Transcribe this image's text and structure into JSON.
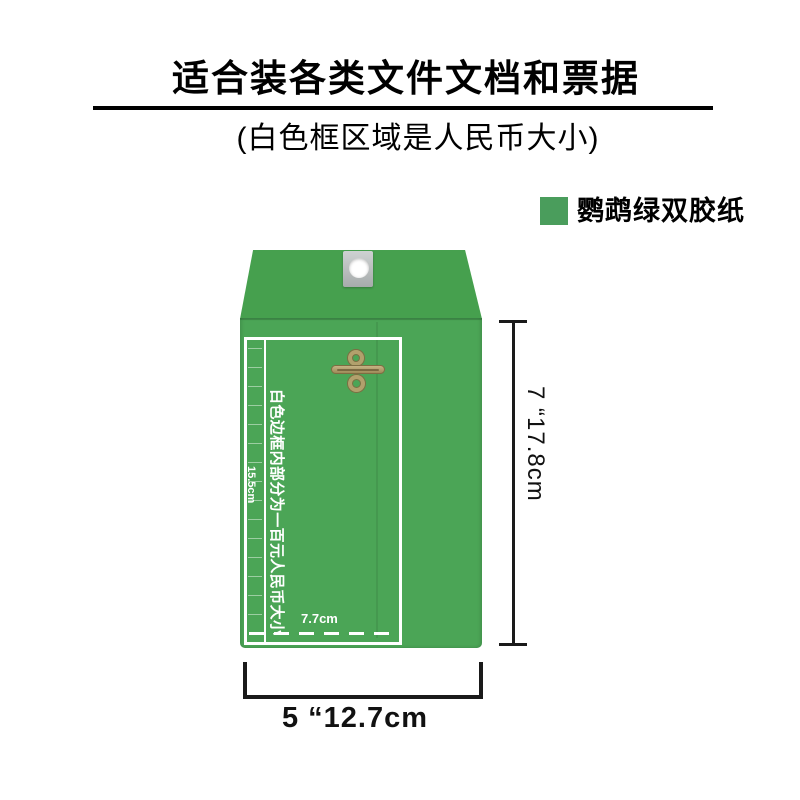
{
  "header": {
    "title": "适合装各类文件文档和票据",
    "subtitle": "(白色框区域是人民币大小)"
  },
  "legend": {
    "label": "鹦鹉绿双胶纸",
    "swatch_color": "#4a9d5c"
  },
  "envelope": {
    "body_color": "#4ba556",
    "flap_color": "#46a04e",
    "clasp_color": "#b2a06c",
    "inner_note": "白色边框内部分为一百元人民币大小",
    "inner_height_label": "15.5cm",
    "inner_width_label": "7.7cm"
  },
  "dimensions": {
    "height_label": "7 “17.8cm",
    "width_label": "5 “12.7cm"
  }
}
